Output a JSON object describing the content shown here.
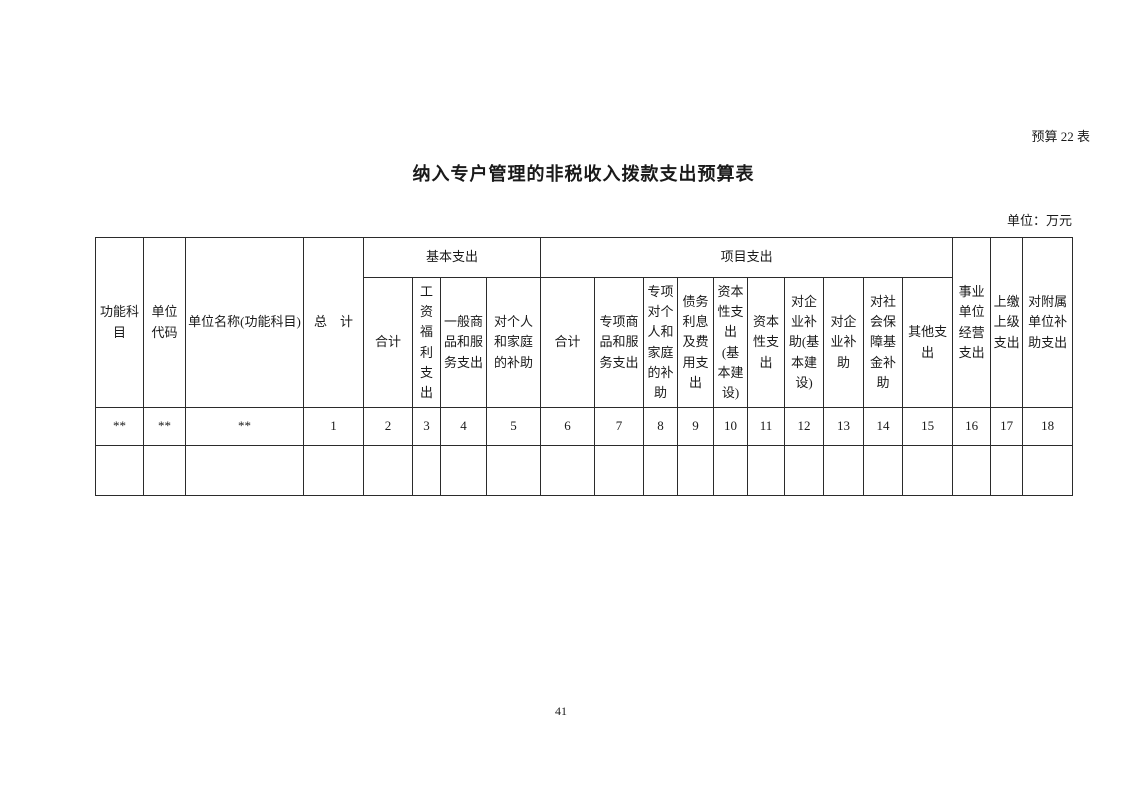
{
  "page": {
    "table_label": "预算 22 表",
    "title": "纳入专户管理的非税收入拨款支出预算表",
    "unit_note": "单位：万元",
    "page_number": "41"
  },
  "table": {
    "header": {
      "function_subject": "功能科目",
      "unit_code": "单位代码",
      "unit_name": "单位名称(功能科目)",
      "grand_total": "总　计",
      "group_basic": "基本支出",
      "basic_cols": [
        "合计",
        "工资福利支出",
        "一般商品和服务支出",
        "对个人和家庭的补助"
      ],
      "group_project": "项目支出",
      "project_cols": [
        "合计",
        "专项商品和服务支出",
        "专项对个人和家庭的补助",
        "债务利息及费用支出",
        "资本性支出(基本建设)",
        "资本性支出",
        "对企业补助(基本建设)",
        "对企业补助",
        "对社会保障基金补助",
        "其他支出"
      ],
      "operating": "事业单位经营支出",
      "upper_level": "上缴上级支出",
      "affiliated": "对附属单位补助支出"
    },
    "index_row": [
      "**",
      "**",
      "**",
      "1",
      "2",
      "3",
      "4",
      "5",
      "6",
      "7",
      "8",
      "9",
      "10",
      "11",
      "12",
      "13",
      "14",
      "15",
      "16",
      "17",
      "18"
    ]
  }
}
